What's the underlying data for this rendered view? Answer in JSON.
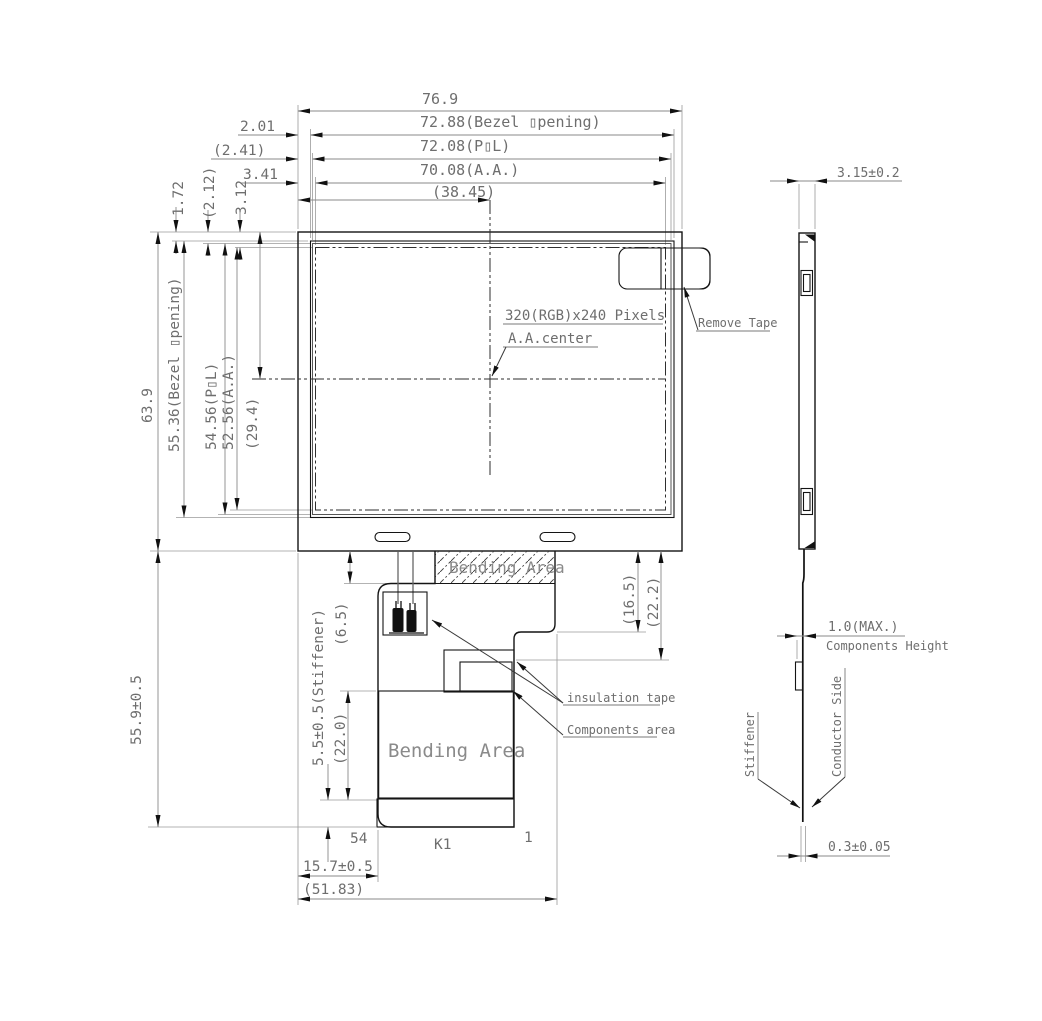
{
  "front": {
    "w_total": "76.9",
    "w_bezel": "72.88(Bezel ▯pening)",
    "w_pol": "72.08(P▯L)",
    "w_aa": "70.08(A.A.)",
    "w_center": "(38.45)",
    "off1": "2.01",
    "off2": "(2.41)",
    "off3": "3.41",
    "top1": "1.72",
    "top2": "(2.12)",
    "top3": "3.12",
    "h_total": "63.9",
    "h_bezel": "55.36(Bezel ▯pening)",
    "h_pol": "54.56(P▯L)",
    "h_aa": "52.56(A.A.)",
    "h_center": "(29.4)",
    "pixels": "320(RGB)x240 Pixels",
    "aa_center": "A.A.center",
    "remove_tape": "Remove Tape",
    "bending_top": "Bending Area",
    "bending_bottom": "Bending Area",
    "flex_gap": "(6.5)",
    "flex_right1": "(16.5)",
    "flex_right2": "(22.2)",
    "flex_h": "55.9±0.5",
    "stiffener_dim": "5.5±0.5(Stiffener)",
    "bend_h": "(22.0)",
    "insulation": "insulation tape",
    "components": "Components area",
    "pin_last": "54",
    "connector": "K1",
    "pin_first": "1",
    "flex_off": "15.7±0.5",
    "flex_w": "(51.83)"
  },
  "side": {
    "thickness": "3.15±0.2",
    "comp_height": "1.0(MAX.)",
    "comp_height2": "Components Height",
    "conductor": "Conductor Side",
    "stiffener": "Stiffener",
    "fpc_thickness": "0.3±0.05"
  }
}
